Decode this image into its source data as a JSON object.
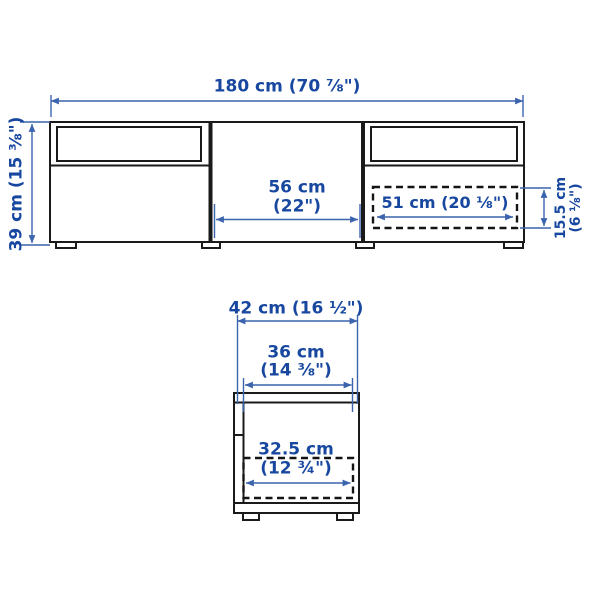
{
  "colors": {
    "dimension_text": "#17479f",
    "dimension_line": "#3c64ad",
    "furniture_outline": "#1a1a1a",
    "background": "#ffffff"
  },
  "front_view": {
    "overall_width": "180 cm (70 ⅞\")",
    "overall_height": "39 cm (15 ⅜\")",
    "door_width_cm": "56 cm",
    "door_width_in": "(22\")",
    "drawer_inner_width": "51 cm (20 ⅛\")",
    "drawer_inner_height_cm": "15.5 cm",
    "drawer_inner_height_in": "(6 ⅛\")"
  },
  "side_view": {
    "overall_depth": "42 cm (16 ½\")",
    "inner_depth_cm": "36 cm",
    "inner_depth_in": "(14 ⅜\")",
    "drawer_inner_depth_cm": "32.5 cm",
    "drawer_inner_depth_in": "(12 ¾\")"
  }
}
